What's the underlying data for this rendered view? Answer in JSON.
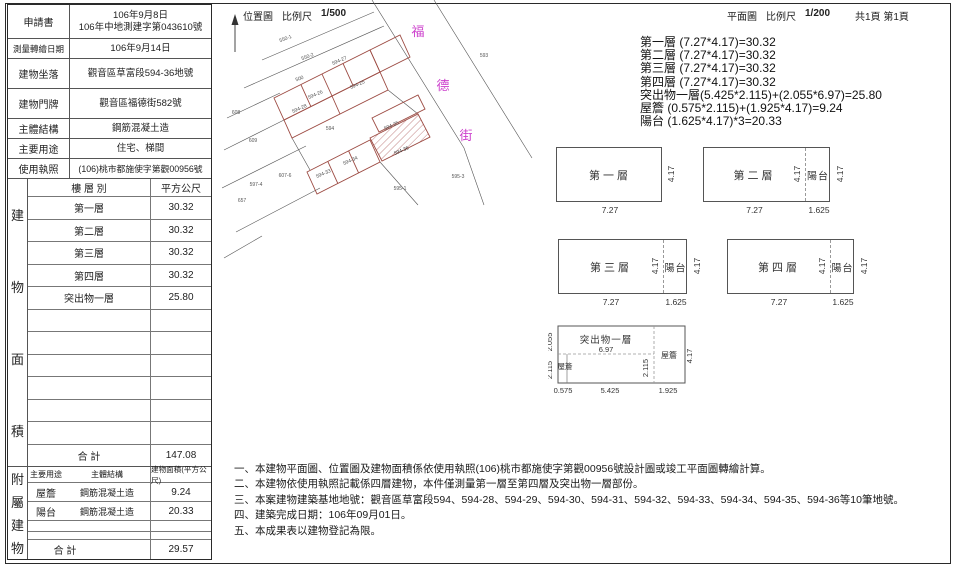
{
  "header": {
    "site_map_title": "位置圖",
    "site_map_scale_label": "比例尺",
    "site_map_scale": "1/500",
    "plan_title": "平面圖",
    "plan_scale_label": "比例尺",
    "plan_scale": "1/200",
    "page_info": "共1頁 第1頁"
  },
  "info_table": {
    "rows": [
      {
        "label": "申請書",
        "value": "106年9月8日",
        "value2": "106年中地測建字第043610號"
      },
      {
        "label": "測量轉繪日期",
        "value": "106年9月14日"
      },
      {
        "label": "建物坐落",
        "value": "觀音區草富段594-36地號"
      },
      {
        "label": "建物門牌",
        "value": "觀音區福德街582號"
      },
      {
        "label": "主體結構",
        "value": "鋼筋混凝土造"
      },
      {
        "label": "主要用途",
        "value": "住宅、梯間"
      },
      {
        "label": "使用執照",
        "value": "(106)桃市都施使字第觀00956號"
      }
    ]
  },
  "area_table": {
    "section_chars": [
      "建",
      "物",
      "面",
      "積"
    ],
    "header_floor": "樓 層 別",
    "header_area": "平方公尺",
    "rows": [
      {
        "floor": "第一層",
        "area": "30.32"
      },
      {
        "floor": "第二層",
        "area": "30.32"
      },
      {
        "floor": "第三層",
        "area": "30.32"
      },
      {
        "floor": "第四層",
        "area": "30.32"
      },
      {
        "floor": "突出物一層",
        "area": "25.80"
      }
    ],
    "total_label": "合  計",
    "total_value": "147.08"
  },
  "annex_table": {
    "section_chars": [
      "附",
      "屬",
      "建",
      "物"
    ],
    "header_use": "主要用途",
    "header_structure": "主體結構",
    "header_area": "建物面積(平方公尺)",
    "rows": [
      {
        "use": "屋簷",
        "structure": "鋼筋混凝土造",
        "area": "9.24"
      },
      {
        "use": "陽台",
        "structure": "鋼筋混凝土造",
        "area": "20.33"
      }
    ],
    "total_label": "合  計",
    "total_value": "29.57"
  },
  "site_map": {
    "street_chars": [
      "福",
      "德",
      "街"
    ],
    "street_color": "#cc3fcc",
    "outline_color": "#9c4a42",
    "parcel_labels": [
      "550-1",
      "550-2",
      "500",
      "594-27",
      "594-25",
      "594-26",
      "594-28",
      "608",
      "609",
      "594",
      "594-35",
      "594-36",
      "594-34",
      "594-33",
      "607-6",
      "597-4",
      "657",
      "595-1",
      "593",
      "595-3"
    ]
  },
  "calculations": {
    "lines": [
      "第一層 (7.27*4.17)=30.32",
      "第二層 (7.27*4.17)=30.32",
      "第三層 (7.27*4.17)=30.32",
      "第四層 (7.27*4.17)=30.32",
      "突出物一層(5.425*2.115)+(2.055*6.97)=25.80",
      "屋簷 (0.575*2.115)+(1.925*4.17)=9.24",
      "陽台 (1.625*4.17)*3=20.33"
    ]
  },
  "floor_plans": {
    "f1": {
      "label": "第一層",
      "width": "7.27",
      "height": "4.17"
    },
    "f2": {
      "label": "第二層",
      "width": "7.27",
      "height": "4.17",
      "balcony_label": "陽台",
      "balcony_width": "1.625",
      "balcony_height": "4.17"
    },
    "f3": {
      "label": "第三層",
      "width": "7.27",
      "height": "4.17",
      "balcony_label": "陽台",
      "balcony_width": "1.625",
      "balcony_height": "4.17"
    },
    "f4": {
      "label": "第四層",
      "width": "7.27",
      "height": "4.17",
      "balcony_label": "陽台",
      "balcony_width": "1.625",
      "balcony_height": "4.17"
    },
    "projection": {
      "label": "突出物一層",
      "eave_label_left": "屋簷",
      "eave_label_right": "屋簷",
      "top_h": "2.055",
      "mid_w": "6.97",
      "left_h": "2.115",
      "right_h": "2.115",
      "full_h": "4.17",
      "w1": "0.575",
      "w2": "5.425",
      "w3": "1.925"
    }
  },
  "notes": {
    "lines": [
      "一、本建物平面圖、位置圖及建物面積係依使用執照(106)桃市都施使字第觀00956號設計圖或竣工平面圖轉繪計算。",
      "二、本建物依使用執照記載係四層建物，本件僅測量第一層至第四層及突出物一層部份。",
      "三、本案建物建築基地地號：觀音區草富段594、594-28、594-29、594-30、594-31、594-32、594-33、594-34、594-35、594-36等10筆地號。",
      "四、建築完成日期：106年09月01日。",
      "五、本成果表以建物登記為限。"
    ]
  }
}
